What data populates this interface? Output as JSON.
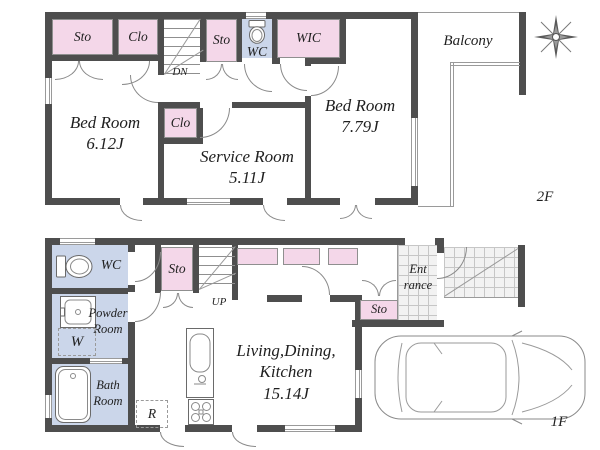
{
  "colors": {
    "wall": "#4e4e4e",
    "room_pink": "#f4d7e9",
    "room_blue": "#cbd6ea",
    "tile_line": "#c6c6c6",
    "thin_line": "#9a9a9a"
  },
  "icons": {
    "compass": "compass-rose",
    "toilet": "toilet",
    "washbasin": "washbasin",
    "bathtub": "bathtub",
    "kitchen_sink": "kitchen-sink-counter",
    "stove": "gas-stove",
    "fridge_slot": "refrigerator-space",
    "washer_slot": "washing-machine-space",
    "car": "car-top-view"
  },
  "floor2": {
    "floor_label": "2F",
    "balcony_label": "Balcony",
    "stairs_label": "DN",
    "rooms": {
      "sto_a": {
        "label": "Sto"
      },
      "clo_a": {
        "label": "Clo"
      },
      "sto_b": {
        "label": "Sto"
      },
      "wc": {
        "label": "WC"
      },
      "wic": {
        "label": "WIC"
      },
      "bedroom_a": {
        "name": "Bed Room",
        "area": "6.12J"
      },
      "clo_b": {
        "label": "Clo"
      },
      "service_room": {
        "name": "Service Room",
        "area": "5.11J"
      },
      "bedroom_b": {
        "name": "Bed Room",
        "area": "7.79J"
      }
    }
  },
  "floor1": {
    "floor_label": "1F",
    "stairs_label": "UP",
    "rooms": {
      "wc": {
        "label": "WC"
      },
      "powder_room": {
        "name_line1": "Powder",
        "name_line2": "Room"
      },
      "washer": {
        "label": "W"
      },
      "bath_room": {
        "name_line1": "Bath",
        "name_line2": "Room"
      },
      "fridge": {
        "label": "R"
      },
      "sto_a": {
        "label": "Sto"
      },
      "sto_b": {
        "label": "Sto"
      },
      "entrance": {
        "name_line1": "Ent",
        "name_line2": "rance"
      },
      "ldk": {
        "name_line1": "Living,Dining,",
        "name_line2": "Kitchen",
        "area": "15.14J"
      }
    }
  }
}
